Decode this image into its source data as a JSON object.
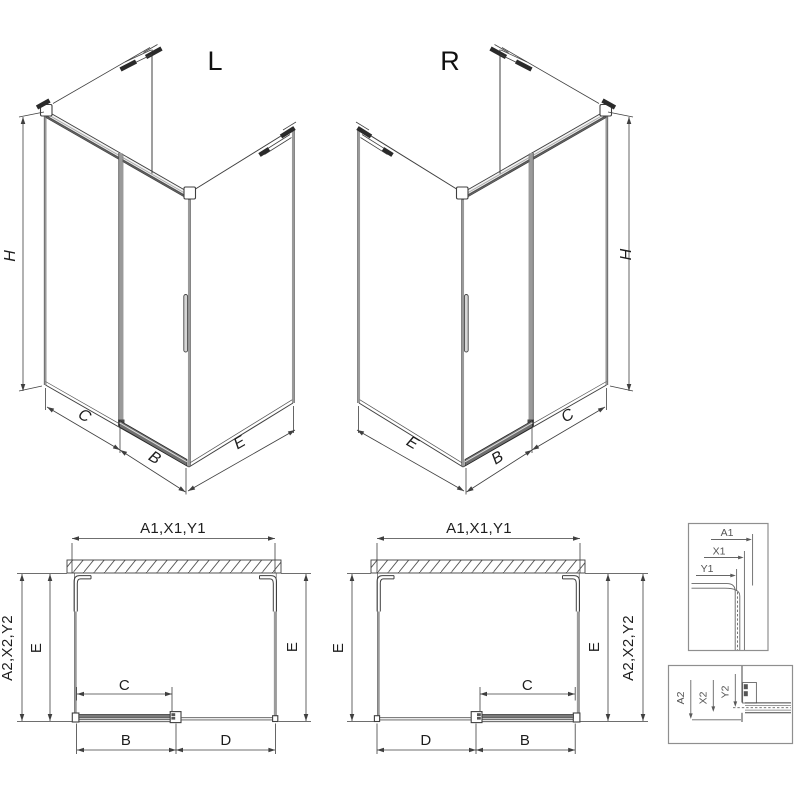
{
  "iso_left": {
    "title": "L",
    "height": "H",
    "seg1": "C",
    "seg2": "B",
    "seg3": "E"
  },
  "iso_right": {
    "title": "R",
    "height": "H",
    "seg1": "E",
    "seg2": "B",
    "seg3": "C"
  },
  "plan_left": {
    "width_top": "A1,X1,Y1",
    "depth_outer_left": "A2,X2,Y2",
    "depth_inner_left": "E",
    "depth_right": "E",
    "opening": "C",
    "bottom_seg1": "B",
    "bottom_seg2": "D"
  },
  "plan_right": {
    "width_top": "A1,X1,Y1",
    "depth_left": "E",
    "depth_inner_right": "E",
    "depth_outer_right": "A2,X2,Y2",
    "opening": "C",
    "bottom_seg1": "D",
    "bottom_seg2": "B"
  },
  "detail_top": {
    "dim1": "A1",
    "dim2": "X1",
    "dim3": "Y1"
  },
  "detail_bottom": {
    "dim1": "A2",
    "dim2": "X2",
    "dim3": "Y2"
  },
  "colors": {
    "line": "#3f3f3f",
    "glass": "#9a9a9a",
    "dimension": "#3f3f3f",
    "detail": "#606060",
    "background": "#ffffff"
  }
}
